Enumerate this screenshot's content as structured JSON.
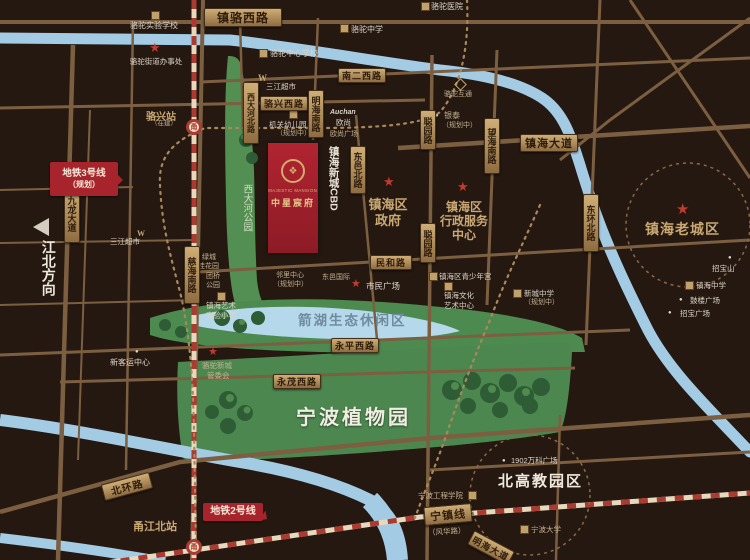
{
  "project": {
    "logo_glyph": "❖",
    "name_en": "MAJESTIC MANSION",
    "name_cn": "中星宸府"
  },
  "roads": {
    "zhenluo_xilu": "镇骆西路",
    "nan2_xilu": "南二西路",
    "luoxing_xilu": "骆兴西路",
    "minghai_nanlu": "明海南路",
    "xidahe_beilu": "西大河北路",
    "dongyi_beilu": "东邑北路",
    "congyuan_lu": "聪园路",
    "wanghai_nanlu": "望海南路",
    "zhenhai_dadao": "镇海大道",
    "minhe_lu": "民和路",
    "yongping_xilu": "永平西路",
    "yongmao_xilu": "永茂西路",
    "beihuan_lu": "北环路",
    "cihai_nanlu": "慈海南路",
    "jiulong_dadao": "九龙大道",
    "donghuan_beilu": "东环北路",
    "minghai_dadao": "明海大道"
  },
  "transit": {
    "metro3_line1": "地铁3号线",
    "metro3_line2": "（规划）",
    "metro2": "地铁2号线",
    "luoxing_station": "骆兴站",
    "luoxing_note": "（在建）",
    "yongjiang_station": "甬江北站",
    "metro_glyph": "甬",
    "ninzhen_xian": "宁镇线",
    "fenghua_lu": "（风华路）"
  },
  "areas": {
    "cbd": "镇海新城CBD",
    "xidahe_park": "西大河公园",
    "jianhu": "箭湖生态休闲区",
    "zhiwuyuan": "宁波植物园",
    "beigaojiao": "北高教园区",
    "laochengqu": "镇海老城区",
    "jiangbei": "江北方向"
  },
  "places": {
    "luotuo_shiyan_xuexiao": "骆驼实验学校",
    "luotuo_jiedao": "骆驼街道办事处",
    "luotuo_zhongxue": "骆驼中学",
    "luotuo_zhongxin_xuexiao": "骆驼中心学校",
    "luotuo_yiyuan": "骆驼医院",
    "luotuo_hutong": "骆驼互通",
    "sanjiang_chaoshi": "三江超市",
    "sanjiang_logo": "W",
    "jiguan_youeryuan": "机关幼儿园",
    "youeryuan_note": "（规划中）",
    "auchan": "Auchan",
    "oushang": "欧尚",
    "oushang_plaza": "欧尚广场",
    "yintai": "银泰",
    "yintai_note": "（规划中）",
    "qu_zhengfu_1": "镇海区",
    "qu_zhengfu_2": "政府",
    "xingzheng_1": "镇海区",
    "xingzheng_2": "行政服务",
    "xingzheng_3": "中心",
    "linli_1": "邻里中心",
    "linli_2": "（规划中）",
    "dongyi_guoji": "东邑国际",
    "shimin_guangchang": "市民广场",
    "qingshaoniangong": "镇海区青少年宫",
    "wenhua_1": "镇海文化",
    "wenhua_2": "艺术中心",
    "xincheng_zhongxue": "新城中学",
    "xincheng_note": "（规划中）",
    "lvcheng_1": "绿城",
    "lvcheng_2": "桂花园",
    "tuanqiao_1": "团桥",
    "tuanqiao_2": "公园",
    "yishu_1": "镇海艺术",
    "yishu_2": "实验小学",
    "xinkeyun": "新客运中心",
    "guanweihui_1": "骆驼新城",
    "guanweihui_2": "管委会",
    "wanke": "1902万科广场",
    "gongcheng_xueyuan": "宁波工程学院",
    "ningbo_daxue": "宁波大学",
    "zhaobaoshan": "招宝山",
    "zhenhai_zhongxue": "镇海中学",
    "gulou_guangchang": "鼓楼广场",
    "zhaobao_guangchang": "招宝广场"
  },
  "icons": {
    "star": "★",
    "dot": "●",
    "arrow": "◀"
  },
  "colors": {
    "background": "#251811",
    "road": "#7c5f40",
    "plaque_gold": "#c9a76f",
    "river": "#a4cbe4",
    "lake": "#b5d9ea",
    "green": "#4c8750",
    "project_red": "#a8242c",
    "metro_red": "#a93b31",
    "metro_cream": "#e7d9bd",
    "gold_text": "#c9a873",
    "white_text": "#ddd6c9",
    "star_red": "#c23b30"
  }
}
